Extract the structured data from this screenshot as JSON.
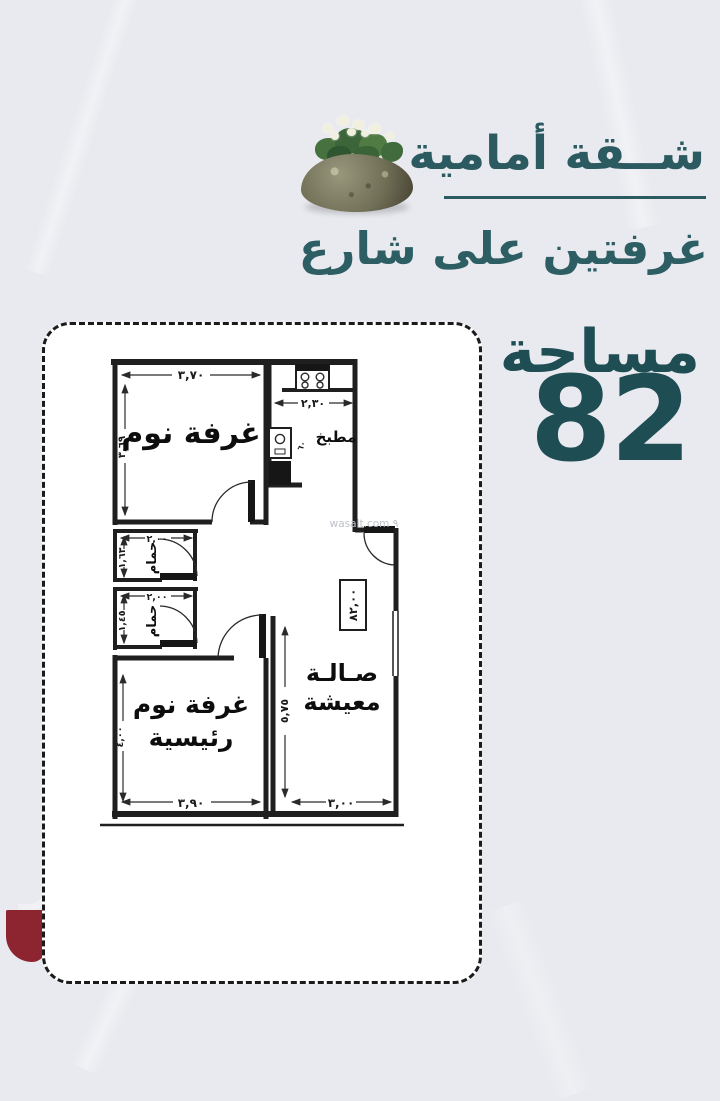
{
  "header": {
    "title": "شــقة أمامية",
    "subtitle": "غرفتين على شارع",
    "area_label": "مساحة",
    "area_value": "82",
    "accent_color": "#2b5a60"
  },
  "floor_plan": {
    "watermark": "wasalt.com ٩",
    "area_box": "٨٢,٠٠",
    "bedroom1": {
      "label": "غرفة نوم",
      "width_dim": "٣,٧٠",
      "height_dim": "٣,٦٩"
    },
    "kitchen": {
      "label": "مطبخ",
      "width_dim": "٢,٣٠",
      "counter_note": "٦٠"
    },
    "bath1": {
      "label": "حمام",
      "width_dim": "٢,٠٠",
      "height_dim": "١,٦٣"
    },
    "bath2": {
      "label": "حمام",
      "width_dim": "٢,٠٠",
      "height_dim": "١,٤٥"
    },
    "master": {
      "label_line1": "غرفة نوم",
      "label_line2": "رئيسية",
      "width_dim": "٣,٩٠",
      "height_dim": "٤,٠٠"
    },
    "living": {
      "label_line1": "صـالـة",
      "label_line2": "معيشة",
      "width_dim": "٣,٠٠",
      "height_dim": "٥,٧٥"
    }
  }
}
